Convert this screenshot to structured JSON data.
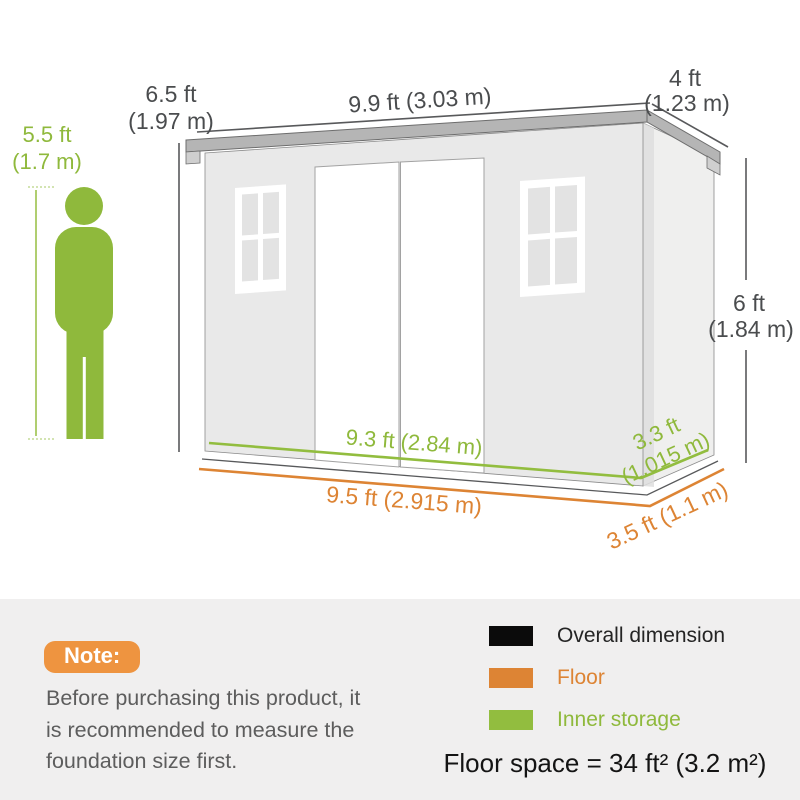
{
  "diagram": {
    "person_height": [
      "5.5 ft",
      "(1.7 m)"
    ],
    "front_height": [
      "6.5 ft",
      "(1.97 m)"
    ],
    "roof_width": "9.9 ft (3.03 m)",
    "roof_depth": [
      "4 ft",
      "(1.23 m)"
    ],
    "wall_height": [
      "6 ft",
      "(1.84 m)"
    ],
    "inner_width": "9.3 ft (2.84 m)",
    "floor_width": "9.5 ft (2.915 m)",
    "inner_depth": [
      "3.3 ft",
      "(1.015 m)"
    ],
    "floor_depth": "3.5 ft (1.1 m)"
  },
  "note": {
    "label": "Note:",
    "lines": [
      "Before purchasing this product, it",
      "is recommended to measure the",
      "foundation size first."
    ]
  },
  "legend": {
    "items": [
      {
        "label": "Overall dimension",
        "color": "#0b0b0b"
      },
      {
        "label": "Floor",
        "color": "#dd8434"
      },
      {
        "label": "Inner storage",
        "color": "#92bd3f"
      }
    ]
  },
  "summary": {
    "floor_space": "Floor space = 34 ft² (3.2 m²)"
  },
  "colors": {
    "overall_line": "#58595b",
    "floor_line": "#dd8434",
    "inner_line": "#92bd3f",
    "person_green": "#8fb93c",
    "note_badge": "#ee9440",
    "panel_bg": "#f0efef"
  }
}
